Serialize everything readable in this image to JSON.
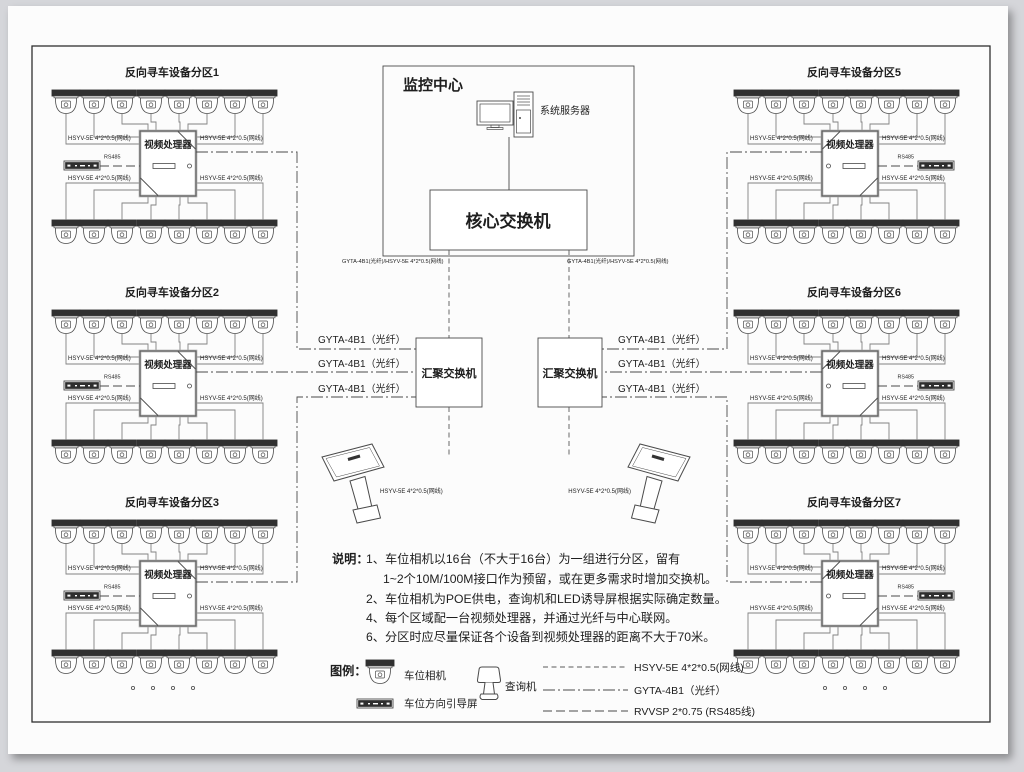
{
  "zones": [
    {
      "id": "1",
      "title": "反向寻车设备分区1",
      "side": "left"
    },
    {
      "id": "2",
      "title": "反向寻车设备分区2",
      "side": "left"
    },
    {
      "id": "3",
      "title": "反向寻车设备分区3",
      "side": "left"
    },
    {
      "id": "5",
      "title": "反向寻车设备分区5",
      "side": "right"
    },
    {
      "id": "6",
      "title": "反向寻车设备分区6",
      "side": "right"
    },
    {
      "id": "7",
      "title": "反向寻车设备分区7",
      "side": "right"
    }
  ],
  "labels": {
    "monitoring_center": "监控中心",
    "server": "系统服务器",
    "core_switch": "核心交换机",
    "agg_switch": "汇聚交换机",
    "core_link": "GYTA-4B1(光纤)/HSYV-5E 4*2*0.5(网线)",
    "fiber": "GYTA-4B1（光纤）",
    "net_cable": "HSYV-5E 4*2*0.5(网线)",
    "kiosk_cable": "HSYV-5E 4*2*0.5(网线)",
    "rs485": "RS485",
    "processor": "视频处理器"
  },
  "notes": {
    "heading": "说明：",
    "lines": [
      "1、车位相机以16台（不大于16台）为一组进行分区，留有",
      "1~2个10M/100M接口作为预留，或在更多需求时增加交换机。",
      "2、车位相机为POE供电，查询机和LED诱导屏根据实际确定数量。",
      "4、每个区域配一台视频处理器，并通过光纤与中心联网。",
      "6、分区时应尽量保证各个设备到视频处理器的距离不大于70米。"
    ]
  },
  "legend": {
    "heading": "图例：",
    "camera": "车位相机",
    "guide_screen": "车位方向引导屏",
    "kiosk": "查询机",
    "line_net": "HSYV-5E 4*2*0.5(网线)",
    "line_fiber": "GYTA-4B1（光纤）",
    "line_rs485": "RVVSP 2*0.75 (RS485线)"
  },
  "colors": {
    "background": "#d5d6da",
    "paper": "#fcfcfc",
    "line": "#4a4a4a",
    "wire": "#828282",
    "camera_band": "#303030",
    "processor_border": "#a9a9a9"
  }
}
